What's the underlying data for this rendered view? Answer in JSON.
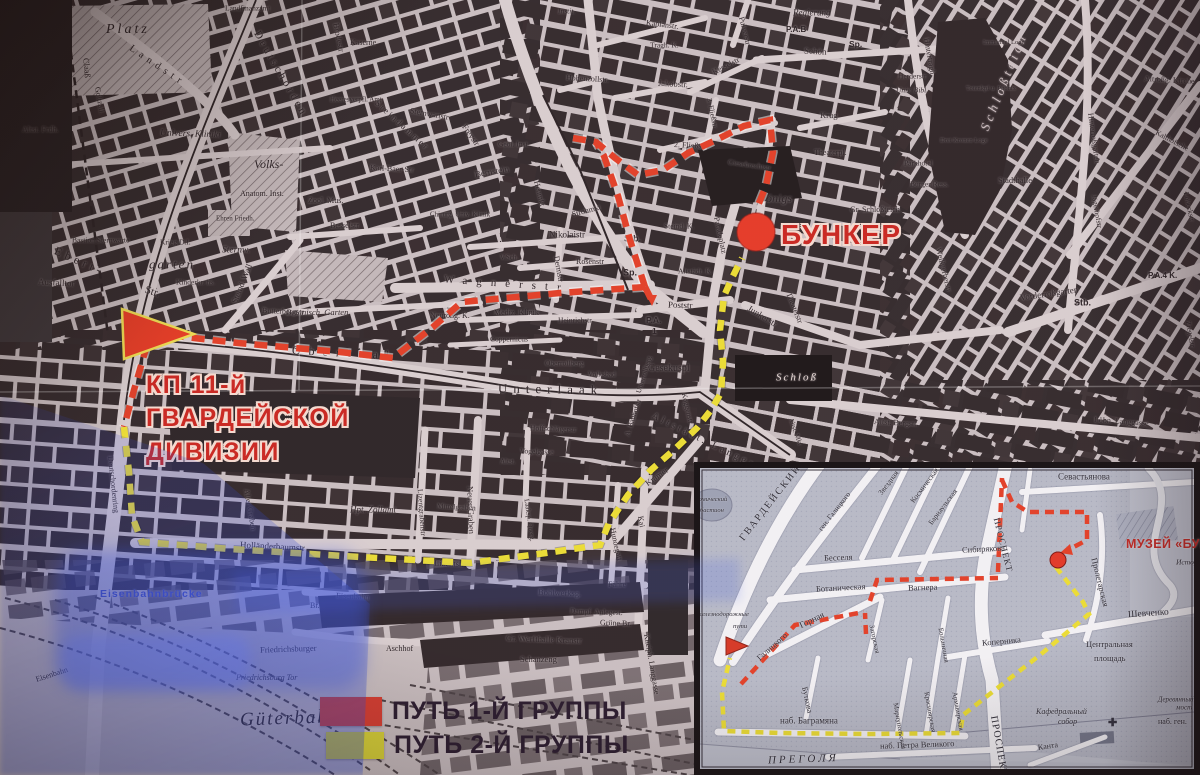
{
  "colors": {
    "route_group1_red": "#e23a22",
    "route_group2_yellow": "#ecdf2e",
    "legend_red": "#d7372a",
    "legend_yellow": "#d9d430",
    "bunker_red": "#c9201a",
    "map_paper": "#c9bfc2",
    "map_block": "#2c2427",
    "inset_paper": "#b6bac8"
  },
  "legend": {
    "items": [
      {
        "swatch": "#d7372a",
        "label": "ПУТЬ 1-Й ГРУППЫ"
      },
      {
        "swatch": "#d9d430",
        "label": "ПУТЬ 2-Й ГРУППЫ"
      }
    ]
  },
  "main_map": {
    "bunker_label": "БУНКЕР",
    "kp_label_lines": [
      "КП 11-й",
      "ГВАРДЕЙСКОЙ",
      "ДИВИЗИИ"
    ],
    "street_labels": [
      [
        "Platz",
        106,
        30,
        14,
        0,
        "i",
        3
      ],
      [
        "Claaß",
        86,
        58,
        8.5,
        85
      ],
      [
        "Goltzall.",
        97,
        87,
        8,
        80
      ],
      [
        "Landstr",
        130,
        48,
        10,
        34,
        "",
        5
      ],
      [
        "Deutschorden",
        256,
        32,
        11,
        60,
        "",
        3
      ],
      [
        "Brodestr",
        336,
        23,
        8.5,
        79
      ],
      [
        "Heeresverpfl. Amt",
        330,
        100,
        7,
        0
      ],
      [
        "Kaserne",
        350,
        43,
        8,
        0
      ],
      [
        "Landfinanzamt",
        225,
        8,
        7.5,
        0
      ],
      [
        "Instit.",
        558,
        11,
        7.5,
        0,
        "i"
      ],
      [
        "Univers. Kliniki",
        160,
        134,
        9.5,
        2,
        "i"
      ],
      [
        "Volks-",
        254,
        164,
        12,
        0,
        "i"
      ],
      [
        "Anatom. Inst.",
        240,
        194,
        8,
        0
      ],
      [
        "Altst. Frdh.",
        22,
        130,
        8,
        0
      ],
      [
        "Bastion Sternwarte",
        72,
        240,
        7.5,
        0
      ],
      [
        "Ehren Friedh.",
        216,
        219,
        7,
        0
      ],
      [
        "Ebert-",
        55,
        250,
        12,
        24,
        "",
        4
      ],
      [
        "Str.",
        145,
        290,
        11,
        18
      ],
      [
        "Ausfalltor",
        38,
        282,
        9,
        3
      ],
      [
        "Krieg D.I.",
        160,
        242,
        7.5,
        0
      ],
      [
        "garten",
        149,
        264,
        13,
        0,
        "i",
        2
      ],
      [
        "Kinderkr. hs.",
        176,
        282,
        7.5,
        0
      ],
      [
        "Sternw.",
        222,
        251,
        9.5,
        0,
        "i"
      ],
      [
        "Steind. Wall",
        234,
        303,
        8.5,
        -68
      ],
      [
        "Botanisch. Garten",
        286,
        312,
        8.5,
        0,
        "i"
      ],
      [
        "Butterbergstr",
        262,
        311,
        8,
        2
      ],
      [
        "Sternwartstr",
        410,
        111,
        8,
        10
      ],
      [
        "Steindammer",
        376,
        102,
        9,
        42,
        "",
        2
      ],
      [
        "Freystr",
        464,
        125,
        8.5,
        55
      ],
      [
        "Karl-Baer-Str",
        370,
        168,
        8,
        3
      ],
      [
        "Bernstein",
        475,
        175,
        9,
        -10
      ],
      [
        "Geol. Inst.",
        498,
        144,
        7.5,
        0
      ],
      [
        "Heumkt",
        536,
        181,
        8,
        76
      ],
      [
        "Zool. Mus.",
        308,
        201,
        8,
        0
      ],
      [
        "Besselstr",
        330,
        226,
        8,
        0
      ],
      [
        "Chirurg. Univ. Klinik",
        430,
        215,
        7,
        0
      ],
      [
        "Nikolaistr",
        549,
        235,
        9,
        0
      ],
      [
        "Strohmkt",
        572,
        215,
        8,
        -15
      ],
      [
        "Rosenstr",
        576,
        262,
        8,
        0
      ],
      [
        "V.Sch.",
        500,
        258,
        7,
        0
      ],
      [
        "Wagnerstr",
        444,
        280,
        11,
        4,
        "",
        9
      ],
      [
        "Dermstr",
        556,
        256,
        8,
        80
      ],
      [
        "Neuroßg. K.",
        430,
        316,
        8,
        0
      ],
      [
        "Mediz. Klinik",
        494,
        313,
        8,
        0
      ],
      [
        "Heinrichstr",
        558,
        320,
        7.5,
        0
      ],
      [
        "Coppernicus",
        490,
        339,
        7.5,
        0
      ],
      [
        "Oberrollberg",
        545,
        363,
        7.5,
        0
      ],
      [
        "Gesekuspl",
        648,
        369,
        10,
        0
      ],
      [
        "Oberlaak",
        292,
        350,
        12,
        3,
        "",
        8
      ],
      [
        "Unterlaak",
        498,
        388,
        13,
        1,
        "",
        6
      ],
      [
        "Hohenzollstr.",
        566,
        78,
        8,
        3
      ],
      [
        "Kaplanstr.",
        646,
        23,
        8,
        7
      ],
      [
        "Jakobstr.",
        658,
        83,
        8.5,
        3
      ],
      [
        "Tragh. K.",
        650,
        45,
        7.5,
        0
      ],
      [
        "Kesselstr",
        713,
        73,
        8,
        -27
      ],
      [
        "3. Fließstr",
        709,
        98,
        7.5,
        78
      ],
      [
        "2. Fließstr",
        674,
        145,
        8,
        3
      ],
      [
        "Giesebrechtstr",
        728,
        162,
        7.5,
        8
      ],
      [
        "Pulverstr",
        741,
        17,
        8,
        76
      ],
      [
        "Regierung",
        793,
        13,
        9,
        0,
        "i"
      ],
      [
        "P.A.B",
        786,
        30,
        8,
        0,
        "b"
      ],
      [
        "Schön",
        804,
        51,
        9,
        3
      ],
      [
        "Sp.",
        849,
        44,
        8.5,
        0,
        "b"
      ],
      [
        "Krug",
        820,
        115,
        8.5,
        0
      ],
      [
        "Theaterpl.",
        814,
        153,
        8,
        0
      ],
      [
        "Theaterstr",
        788,
        293,
        8,
        68
      ],
      [
        "Steind. K.",
        664,
        226,
        7.5,
        0
      ],
      [
        "Stb.",
        624,
        239,
        9,
        0,
        "b"
      ],
      [
        "Sp.",
        623,
        273,
        9,
        0,
        "b"
      ],
      [
        "Altstädt. K.",
        678,
        271,
        7.5,
        0
      ],
      [
        "P.A.",
        646,
        320,
        8.5,
        0,
        "b"
      ],
      [
        "1",
        652,
        331,
        8.5,
        0,
        "b"
      ],
      [
        "Poststr",
        668,
        305,
        9,
        2
      ],
      [
        "Junkerstr",
        748,
        308,
        9,
        31
      ],
      [
        "Paradeplatz",
        716,
        217,
        8,
        78
      ],
      [
        "önigs",
        766,
        198,
        12,
        0,
        "i"
      ],
      [
        "Schloß",
        776,
        378,
        11,
        0,
        "i",
        2,
        "#e8dbd8"
      ],
      [
        "Altstädt. Langgasse",
        652,
        416,
        10,
        26,
        "",
        3
      ],
      [
        "Altst. Mkt",
        790,
        418,
        7,
        70
      ],
      [
        "Altst. Bergstr.",
        874,
        422,
        8,
        3
      ],
      [
        "Löbn. Langgasse",
        1094,
        420,
        8,
        4
      ],
      [
        "Gr. Schloßteich",
        850,
        210,
        8,
        0
      ],
      [
        "Weißgerberstr",
        938,
        248,
        8,
        76
      ],
      [
        "Hintertragh.",
        926,
        38,
        8,
        80
      ],
      [
        "Schloßteich",
        984,
        130,
        13,
        -68,
        "i",
        4,
        "#c9bcbf"
      ],
      [
        "Immanuel Loge",
        983,
        43,
        6.5,
        0
      ],
      [
        "Totenkpf u. Phönix",
        966,
        89,
        6.5,
        0
      ],
      [
        "Herderstr",
        898,
        76,
        7.5,
        0
      ],
      [
        "Univ. Bibl.",
        896,
        90,
        7.5,
        0,
        "i"
      ],
      [
        "Drei Kronen Loge",
        940,
        141,
        6.5,
        0
      ],
      [
        "Parkhotel",
        904,
        163,
        7.5,
        0
      ],
      [
        "Bürger Ress.",
        910,
        184,
        7.5,
        0
      ],
      [
        "Stadthalle",
        998,
        180,
        8.5,
        0
      ],
      [
        "Altroßg. Kirche",
        1144,
        79,
        8,
        3
      ],
      [
        "Kalthofsche",
        1156,
        132,
        7.5,
        28
      ],
      [
        "Jägerhofstr",
        1094,
        195,
        7.5,
        80
      ],
      [
        "Lobeckstr",
        1186,
        192,
        7.5,
        78
      ],
      [
        "Hinterroßgarten",
        1090,
        113,
        8,
        82
      ],
      [
        "Vorderroßgarten",
        1020,
        298,
        9,
        -8
      ],
      [
        "P.A.4 K.",
        1148,
        276,
        8,
        0,
        "b"
      ],
      [
        "Stb.",
        1074,
        303,
        9,
        0,
        "b"
      ],
      [
        "Ziegelstr",
        1188,
        321,
        7.5,
        80
      ],
      [
        "Kneiph. Langgasse",
        646,
        634,
        8,
        80
      ],
      [
        "Kai",
        640,
        516,
        8,
        80
      ],
      [
        "Hundegatt",
        612,
        528,
        8,
        77
      ],
      [
        "Fähre",
        608,
        585,
        8,
        0
      ],
      [
        "Bohlwerksg.",
        538,
        592,
        8.5,
        2
      ],
      [
        "Dampf. Anlegest.",
        570,
        611,
        7.5,
        2
      ],
      [
        "Grüne Br.",
        600,
        623,
        8,
        2
      ],
      [
        "Gr. Werfthalle Kranstr",
        506,
        638,
        8.5,
        2
      ],
      [
        "Schanzeng",
        520,
        659,
        8.5,
        0
      ],
      [
        "Aschhof",
        386,
        649,
        8,
        0
      ],
      [
        "Lizentstr",
        434,
        563,
        8.5,
        2
      ],
      [
        "Holländerbaumstr",
        240,
        545,
        9,
        3
      ],
      [
        "Lizentgrabenstr",
        420,
        489,
        7.5,
        86
      ],
      [
        "Neuer Graben",
        470,
        486,
        8.5,
        88
      ],
      [
        "Mittelgraben",
        437,
        506,
        7.5,
        3
      ],
      [
        "Hoffschlägerstr",
        530,
        428,
        7.5,
        2
      ],
      [
        "Vogelgasse",
        520,
        451,
        7.5,
        2
      ],
      [
        "Altst.",
        500,
        462,
        7,
        0
      ],
      [
        "Laaksp. Querg.",
        526,
        499,
        7,
        82
      ],
      [
        "Kramer",
        646,
        484,
        8.5,
        -35
      ],
      [
        "Koggenstr",
        684,
        393,
        7.5,
        77
      ],
      [
        "A. Bauhofstr",
        627,
        436,
        7.5,
        -72
      ],
      [
        "Volksbad",
        588,
        374,
        7.5,
        0
      ],
      [
        "Unterrollberg",
        639,
        393,
        7,
        -73
      ],
      [
        "Hpt. Zollamt",
        350,
        510,
        9,
        0,
        "i"
      ],
      [
        "Alter Graben",
        246,
        489,
        8,
        80
      ],
      [
        "Deutschordenring",
        110,
        456,
        8,
        84
      ],
      [
        "Eisenbahn",
        36,
        680,
        8,
        -18
      ],
      [
        "Br.",
        310,
        606,
        8,
        0
      ],
      [
        "Eisenbahn",
        336,
        596,
        8,
        3
      ],
      [
        "Eisenbahnbrücke",
        100,
        594,
        10.5,
        0,
        "b",
        1,
        "#3647c0"
      ],
      [
        "Friedrichsburger",
        260,
        650,
        8.5,
        -2
      ],
      [
        "Friedrichsburg Tor",
        236,
        678,
        8,
        0,
        "i"
      ],
      [
        "Güterbahnhof",
        240,
        720,
        19,
        -2,
        "i",
        2
      ]
    ]
  },
  "inset_map": {
    "museum_label": "МУЗЕЙ «БУНКЕР»",
    "street_labels": [
      [
        "Севастьянова",
        1058,
        477,
        9,
        0
      ],
      [
        "Пролетарская",
        1094,
        558,
        8.5,
        76
      ],
      [
        "Шевченко",
        1128,
        616,
        9.5,
        -4
      ],
      [
        "Истор. муз.",
        1176,
        562,
        7.5,
        0,
        "i"
      ],
      [
        "Центральная",
        1086,
        644,
        8.5,
        0
      ],
      [
        "площадь",
        1094,
        658,
        8.5,
        0
      ],
      [
        "Кафедральный",
        1036,
        712,
        8,
        0,
        "i"
      ],
      [
        "собор",
        1058,
        722,
        8,
        0,
        "i"
      ],
      [
        "Канта",
        1038,
        748,
        8,
        -8
      ],
      [
        "наб. Петра Великого",
        880,
        746,
        8.5,
        -2
      ],
      [
        "ПРЕГОЛЯ",
        768,
        761,
        11,
        -2,
        "i",
        3
      ],
      [
        "наб. Баграмяна",
        780,
        721,
        9,
        0
      ],
      [
        "Деревянный",
        1158,
        700,
        7,
        0,
        "i"
      ],
      [
        "мост",
        1176,
        708,
        7,
        0,
        "i"
      ],
      [
        "наб. ген.",
        1158,
        722,
        8,
        0
      ],
      [
        "Горная",
        800,
        626,
        9,
        -26
      ],
      [
        "Галицкого",
        758,
        659,
        8.5,
        -42
      ],
      [
        "Буткова",
        804,
        687,
        8,
        78
      ],
      [
        "Мариупольская",
        895,
        703,
        7,
        80
      ],
      [
        "Красноярская",
        926,
        692,
        7,
        80
      ],
      [
        "Армавирская",
        954,
        692,
        7,
        80
      ],
      [
        "Больничная",
        940,
        628,
        7,
        80
      ],
      [
        "Коперника",
        982,
        643,
        8.5,
        -5
      ],
      [
        "Загорская",
        871,
        625,
        7,
        78
      ],
      [
        "Вагнера",
        908,
        588,
        8.5,
        -2
      ],
      [
        "Ботаническая",
        816,
        589,
        8.5,
        -3
      ],
      [
        "Бесселя",
        824,
        558,
        8.5,
        -2
      ],
      [
        "Сибирякова",
        962,
        550,
        8.5,
        -3
      ],
      [
        "Барнаульская",
        930,
        524,
        7.5,
        -53
      ],
      [
        "Космическая",
        912,
        502,
        7.5,
        -53
      ],
      [
        "Звездная",
        880,
        494,
        7.5,
        -53
      ],
      [
        "ген. Галицкого",
        820,
        530,
        7.5,
        -52
      ],
      [
        "ГВАРДЕЙСКИЙ",
        742,
        540,
        10,
        -52,
        "",
        2
      ],
      [
        "ПРОСПЕКТ",
        996,
        518,
        9,
        76,
        "",
        1
      ],
      [
        "ПРОСПЕКТ",
        993,
        716,
        10,
        80,
        "",
        1
      ],
      [
        "ономический",
        692,
        500,
        6.5,
        0,
        "i"
      ],
      [
        "бастион",
        700,
        511,
        6.5,
        0,
        "i"
      ],
      [
        "железнодорожные",
        696,
        615,
        6.5,
        0,
        "i"
      ],
      [
        "пути",
        733,
        627,
        6.5,
        0,
        "i"
      ]
    ]
  }
}
